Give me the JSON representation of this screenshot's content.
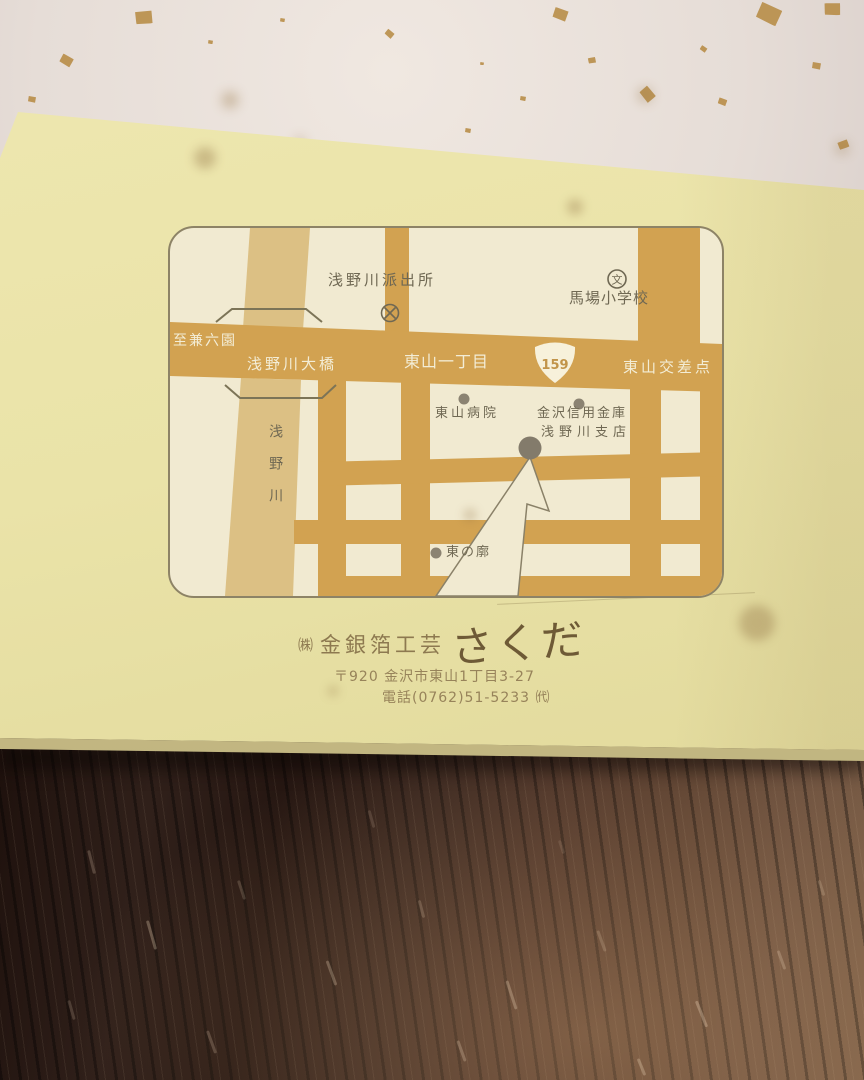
{
  "map": {
    "labels": {
      "police_box": "浅野川派出所",
      "police_symbol": "×",
      "school": "馬場小学校",
      "school_symbol": "文",
      "to_kenrokuen": "至兼六園",
      "bridge": "浅野川大橋",
      "district": "東山一丁目",
      "route_number": "159",
      "intersection": "東山交差点",
      "hospital": "東山病院",
      "bank_line1": "金沢信用金庫",
      "bank_line2": "浅野川支店",
      "river": "浅野川",
      "higashi_quarter": "東の廓"
    },
    "colors": {
      "road": "#d2a251",
      "river": "#dcc084",
      "map_background": "#f1ead1",
      "map_border": "#8d8366",
      "label_text": "#6f6853",
      "road_text": "#f3edd6",
      "marker": "#8b8372"
    }
  },
  "business": {
    "company_prefix": "㈱",
    "company_name": "金銀箔工芸",
    "company_logo": "さくだ",
    "address": "〒920 金沢市東山1丁目3-27",
    "phone": "電話(0762)51-5233 ㈹"
  },
  "scene_colors": {
    "card_paper": "#eae3a8",
    "flecked_paper": "#e8e0d9",
    "gold_flake": "#b5883f",
    "wood_table": "#2c1b16"
  }
}
